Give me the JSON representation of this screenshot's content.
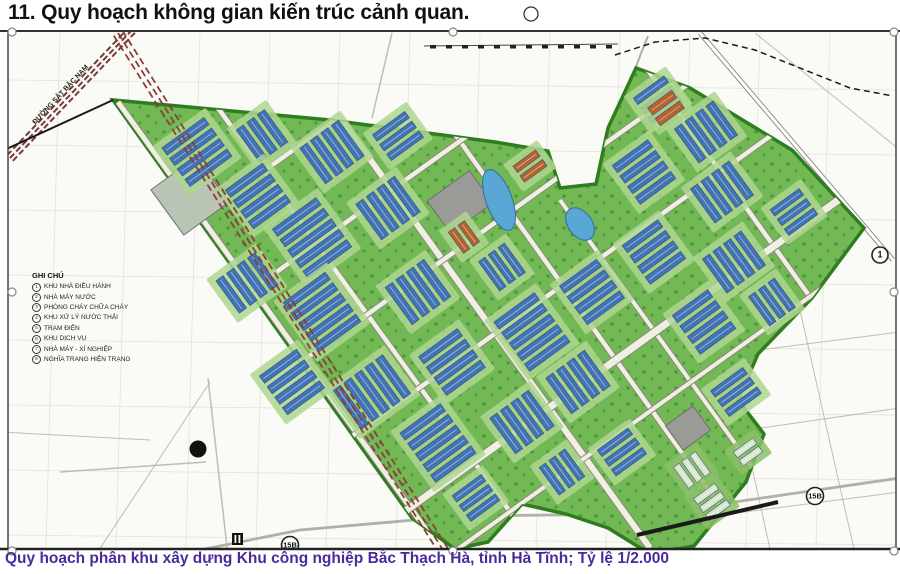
{
  "title": "11. Quy hoạch không gian kiến trúc cảnh quan.",
  "caption": "Quy hoạch phân khu xây dựng Khu công nghiệp Bắc Thạch Hà, tỉnh Hà Tĩnh; Tỷ lệ 1/2.000",
  "legend": {
    "header": "GHI CHÚ",
    "items": [
      {
        "num": "1",
        "label": "KHU NHÀ ĐIỀU HÀNH"
      },
      {
        "num": "2",
        "label": "NHÀ MÁY NƯỚC"
      },
      {
        "num": "3",
        "label": "PHÒNG CHÁY CHỮA CHÁY"
      },
      {
        "num": "4",
        "label": "KHU XỬ LÝ NƯỚC THẢI"
      },
      {
        "num": "5",
        "label": "TRẠM ĐIỆN"
      },
      {
        "num": "6",
        "label": "KHU DỊCH VỤ"
      },
      {
        "num": "7",
        "label": "NHÀ MÁY - XÍ NGHIỆP"
      },
      {
        "num": "8",
        "label": "NGHĨA TRANG HIỆN TRẠNG"
      }
    ]
  },
  "map": {
    "railway_label": "ĐƯỜNG SẮT BẮC NAM",
    "road_signs": [
      {
        "label": "15B",
        "x": 290,
        "y": 545,
        "r": 8.5
      },
      {
        "label": "15B",
        "x": 815,
        "y": 496,
        "r": 8.5
      },
      {
        "label": "1",
        "x": 880,
        "y": 255,
        "r": 8
      }
    ],
    "colors": {
      "map_bg": "#fafaf6",
      "grid": "#e3e3da",
      "zone_fill": "#72b855",
      "zone_edge": "#2e7d1f",
      "tree_dot": "#2f7d26",
      "pad": "#aed68f",
      "building_blue": "#4273b4",
      "building_orange": "#b5622f",
      "building_light": "#d9e6cf",
      "road_in_fill": "#efefe2",
      "road_in_case": "#8a8a7a",
      "road_out": "#b0b0a8",
      "paved": "#9a9a96",
      "pond_fill": "#58a7d4",
      "pond_edge": "#2e6ea0",
      "railway": "#8a4038",
      "frame": "#444444",
      "black": "#1a1a1a"
    },
    "zone_polygon": "113,100 330,120 495,142 548,151 560,188 596,184 608,128 636,68 690,88 792,150 864,228 812,298 758,354 738,400 764,434 746,482 694,546 650,554 608,528 566,514 522,504 488,542 455,549 412,518",
    "roads_in": [
      [
        218,
        108,
        545,
        560,
        4.5
      ],
      [
        336,
        112,
        650,
        548,
        6
      ],
      [
        452,
        130,
        730,
        520,
        4.5
      ],
      [
        560,
        200,
        760,
        478,
        4
      ],
      [
        642,
        62,
        838,
        336,
        4.5
      ],
      [
        118,
        102,
        448,
        560,
        5
      ],
      [
        160,
        245,
        560,
        -40,
        4.5
      ],
      [
        212,
        318,
        652,
        4,
        4.5
      ],
      [
        262,
        390,
        716,
        64,
        4.5
      ],
      [
        316,
        462,
        790,
        122,
        4.5
      ],
      [
        372,
        535,
        862,
        183,
        7
      ],
      [
        448,
        556,
        900,
        232,
        4
      ]
    ],
    "roads_out": [
      [
        700,
        33,
        893,
        260,
        2.5
      ],
      [
        208,
        378,
        228,
        556,
        1.5
      ],
      [
        60,
        472,
        206,
        462,
        1.5
      ],
      [
        0,
        432,
        150,
        440,
        1
      ],
      [
        95,
        556,
        210,
        382,
        1
      ],
      [
        628,
        302,
        690,
        558,
        1
      ],
      [
        712,
        286,
        772,
        558,
        1
      ],
      [
        800,
        310,
        856,
        558,
        1
      ],
      [
        618,
        368,
        900,
        332,
        1
      ],
      [
        636,
        446,
        900,
        408,
        1
      ],
      [
        652,
        524,
        900,
        492,
        1
      ],
      [
        392,
        33,
        372,
        118,
        1.5
      ],
      [
        755,
        33,
        900,
        150,
        1
      ]
    ],
    "route_15b": "150,560 300,530 460,516 640,514 700,507 900,478",
    "notch_road": "M648,36 C630,80 612,130 596,208",
    "dashed_boundary": "615,55 655,42 705,38 755,50 805,70 850,88 893,96",
    "rail_ticks": {
      "x1": 424,
      "y1": 46,
      "x2": 618,
      "y2": 44
    },
    "railway_corridor": {
      "x1": 118,
      "y1": 33,
      "x2": 448,
      "y2": 558
    },
    "railway_topleft": {
      "x1": 10,
      "y1": 158,
      "x2": 132,
      "y2": 30
    },
    "black_segments": [
      [
        0,
        152,
        113,
        100,
        2
      ],
      [
        637,
        535,
        778,
        502,
        4
      ]
    ],
    "paved_areas": [
      {
        "cx": 190,
        "cy": 196,
        "w": 56,
        "h": 56,
        "rot": -36,
        "fill": "#b9c4b4"
      },
      {
        "cx": 460,
        "cy": 202,
        "w": 52,
        "h": 40,
        "rot": -36,
        "fill": "#9a9a96"
      },
      {
        "cx": 688,
        "cy": 428,
        "w": 34,
        "h": 30,
        "rot": -36,
        "fill": "#9a9a96"
      }
    ],
    "ponds": [
      {
        "cx": 499,
        "cy": 200,
        "rx": 13,
        "ry": 32,
        "rot": -20
      },
      {
        "cx": 580,
        "cy": 224,
        "rx": 12,
        "ry": 18,
        "rot": -36
      }
    ],
    "clusters": [
      {
        "x": 197,
        "y": 152,
        "rot": -36,
        "n": 4,
        "len": 52,
        "w": 9,
        "gap": 4,
        "type": "blue"
      },
      {
        "x": 262,
        "y": 136,
        "rot": 54,
        "n": 3,
        "len": 40,
        "w": 9,
        "gap": 4,
        "type": "blue"
      },
      {
        "x": 258,
        "y": 196,
        "rot": -36,
        "n": 4,
        "len": 46,
        "w": 9,
        "gap": 4,
        "type": "blue"
      },
      {
        "x": 332,
        "y": 152,
        "rot": 54,
        "n": 4,
        "len": 44,
        "w": 9,
        "gap": 4,
        "type": "blue"
      },
      {
        "x": 398,
        "y": 136,
        "rot": -36,
        "n": 3,
        "len": 40,
        "w": 8,
        "gap": 4,
        "type": "blue"
      },
      {
        "x": 312,
        "y": 238,
        "rot": -36,
        "n": 5,
        "len": 54,
        "w": 9,
        "gap": 4,
        "type": "blue"
      },
      {
        "x": 388,
        "y": 208,
        "rot": 54,
        "n": 4,
        "len": 44,
        "w": 9,
        "gap": 4,
        "type": "blue"
      },
      {
        "x": 247,
        "y": 283,
        "rot": 54,
        "n": 4,
        "len": 40,
        "w": 9,
        "gap": 4,
        "type": "blue"
      },
      {
        "x": 322,
        "y": 312,
        "rot": -36,
        "n": 5,
        "len": 52,
        "w": 9,
        "gap": 4,
        "type": "blue"
      },
      {
        "x": 418,
        "y": 292,
        "rot": 54,
        "n": 4,
        "len": 46,
        "w": 9,
        "gap": 4,
        "type": "blue"
      },
      {
        "x": 292,
        "y": 382,
        "rot": -36,
        "n": 4,
        "len": 46,
        "w": 9,
        "gap": 4,
        "type": "blue"
      },
      {
        "x": 372,
        "y": 392,
        "rot": 54,
        "n": 5,
        "len": 48,
        "w": 9,
        "gap": 4,
        "type": "blue"
      },
      {
        "x": 452,
        "y": 362,
        "rot": -36,
        "n": 4,
        "len": 48,
        "w": 9,
        "gap": 4,
        "type": "blue"
      },
      {
        "x": 438,
        "y": 443,
        "rot": -36,
        "n": 5,
        "len": 50,
        "w": 9,
        "gap": 4,
        "type": "blue"
      },
      {
        "x": 522,
        "y": 422,
        "rot": 54,
        "n": 4,
        "len": 44,
        "w": 9,
        "gap": 4,
        "type": "blue"
      },
      {
        "x": 532,
        "y": 332,
        "rot": -36,
        "n": 5,
        "len": 50,
        "w": 9,
        "gap": 4,
        "type": "blue"
      },
      {
        "x": 502,
        "y": 267,
        "rot": 54,
        "n": 3,
        "len": 36,
        "w": 8,
        "gap": 4,
        "type": "blue"
      },
      {
        "x": 592,
        "y": 292,
        "rot": -36,
        "n": 4,
        "len": 46,
        "w": 9,
        "gap": 4,
        "type": "blue"
      },
      {
        "x": 578,
        "y": 382,
        "rot": 54,
        "n": 4,
        "len": 44,
        "w": 9,
        "gap": 4,
        "type": "blue"
      },
      {
        "x": 622,
        "y": 452,
        "rot": -36,
        "n": 3,
        "len": 38,
        "w": 8,
        "gap": 4,
        "type": "blue"
      },
      {
        "x": 658,
        "y": 100,
        "rot": -36,
        "n": 3,
        "len": 38,
        "w": 8,
        "gap": 4,
        "type": "blue"
      },
      {
        "x": 706,
        "y": 132,
        "rot": 54,
        "n": 4,
        "len": 42,
        "w": 9,
        "gap": 4,
        "type": "blue"
      },
      {
        "x": 644,
        "y": 172,
        "rot": -36,
        "n": 4,
        "len": 44,
        "w": 9,
        "gap": 4,
        "type": "blue"
      },
      {
        "x": 722,
        "y": 192,
        "rot": 54,
        "n": 4,
        "len": 42,
        "w": 9,
        "gap": 4,
        "type": "blue"
      },
      {
        "x": 654,
        "y": 252,
        "rot": -36,
        "n": 4,
        "len": 44,
        "w": 9,
        "gap": 4,
        "type": "blue"
      },
      {
        "x": 734,
        "y": 262,
        "rot": 54,
        "n": 4,
        "len": 42,
        "w": 9,
        "gap": 4,
        "type": "blue"
      },
      {
        "x": 704,
        "y": 322,
        "rot": -36,
        "n": 4,
        "len": 44,
        "w": 9,
        "gap": 4,
        "type": "blue"
      },
      {
        "x": 794,
        "y": 212,
        "rot": -36,
        "n": 3,
        "len": 36,
        "w": 8,
        "gap": 4,
        "type": "blue"
      },
      {
        "x": 772,
        "y": 302,
        "rot": 54,
        "n": 3,
        "len": 36,
        "w": 8,
        "gap": 4,
        "type": "blue"
      },
      {
        "x": 736,
        "y": 392,
        "rot": -36,
        "n": 3,
        "len": 40,
        "w": 8,
        "gap": 4,
        "type": "blue"
      },
      {
        "x": 562,
        "y": 472,
        "rot": 54,
        "n": 3,
        "len": 34,
        "w": 8,
        "gap": 4,
        "type": "blue"
      },
      {
        "x": 476,
        "y": 498,
        "rot": -36,
        "n": 3,
        "len": 36,
        "w": 8,
        "gap": 4,
        "type": "blue"
      },
      {
        "x": 464,
        "y": 237,
        "rot": 54,
        "n": 2,
        "len": 26,
        "w": 8,
        "gap": 4,
        "type": "orange"
      },
      {
        "x": 530,
        "y": 166,
        "rot": -36,
        "n": 2,
        "len": 28,
        "w": 8,
        "gap": 4,
        "type": "orange"
      },
      {
        "x": 666,
        "y": 108,
        "rot": -36,
        "n": 2,
        "len": 30,
        "w": 9,
        "gap": 4,
        "type": "orange"
      },
      {
        "x": 692,
        "y": 470,
        "rot": 54,
        "n": 3,
        "len": 26,
        "w": 7,
        "gap": 3,
        "type": "light"
      },
      {
        "x": 712,
        "y": 502,
        "rot": -36,
        "n": 3,
        "len": 26,
        "w": 7,
        "gap": 3,
        "type": "light"
      },
      {
        "x": 748,
        "y": 452,
        "rot": -36,
        "n": 2,
        "len": 24,
        "w": 7,
        "gap": 3,
        "type": "light"
      }
    ],
    "black_dot": {
      "x": 198,
      "y": 449,
      "r": 8.5
    },
    "gate_icon": {
      "x": 232,
      "y": 533,
      "w": 11,
      "h": 12
    },
    "handles": [
      [
        12,
        32
      ],
      [
        453,
        32
      ],
      [
        894,
        32
      ],
      [
        12,
        292
      ],
      [
        894,
        292
      ],
      [
        12,
        551
      ],
      [
        453,
        551
      ],
      [
        894,
        551
      ]
    ],
    "rotation_handle": {
      "x": 531,
      "y": 14,
      "r": 7
    }
  }
}
